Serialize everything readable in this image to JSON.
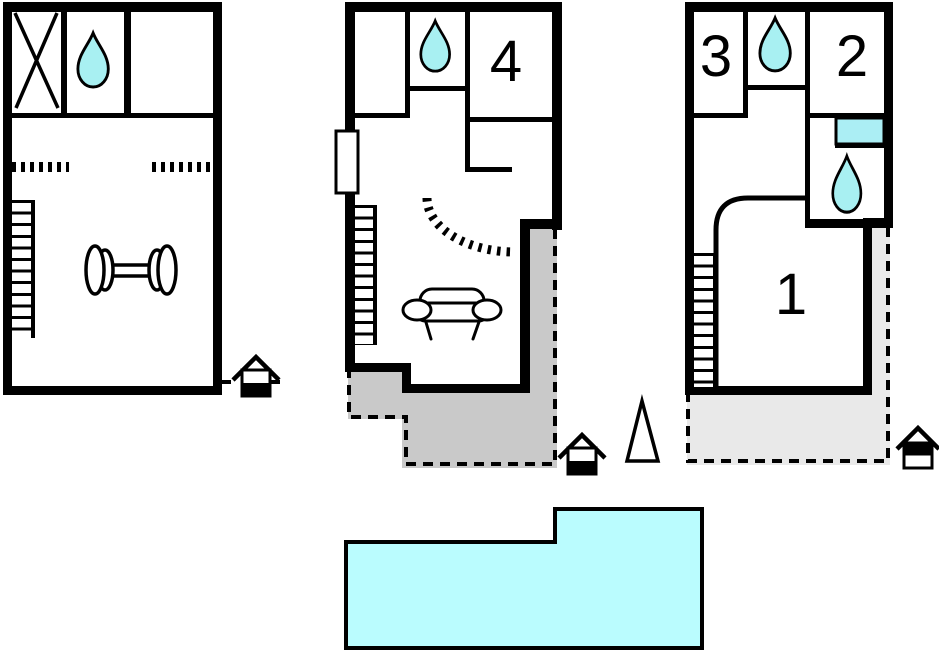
{
  "rooms": {
    "r1": "1",
    "r2": "2",
    "r3": "3",
    "r4": "4"
  },
  "colors": {
    "wall": "#000000",
    "water": "#a8f0f2",
    "pool": "#bafcfe",
    "fixture": "#abeef4",
    "terrace_middle": "#c9c9c9",
    "terrace_right": "#e9e9e9",
    "background": "#ffffff"
  }
}
